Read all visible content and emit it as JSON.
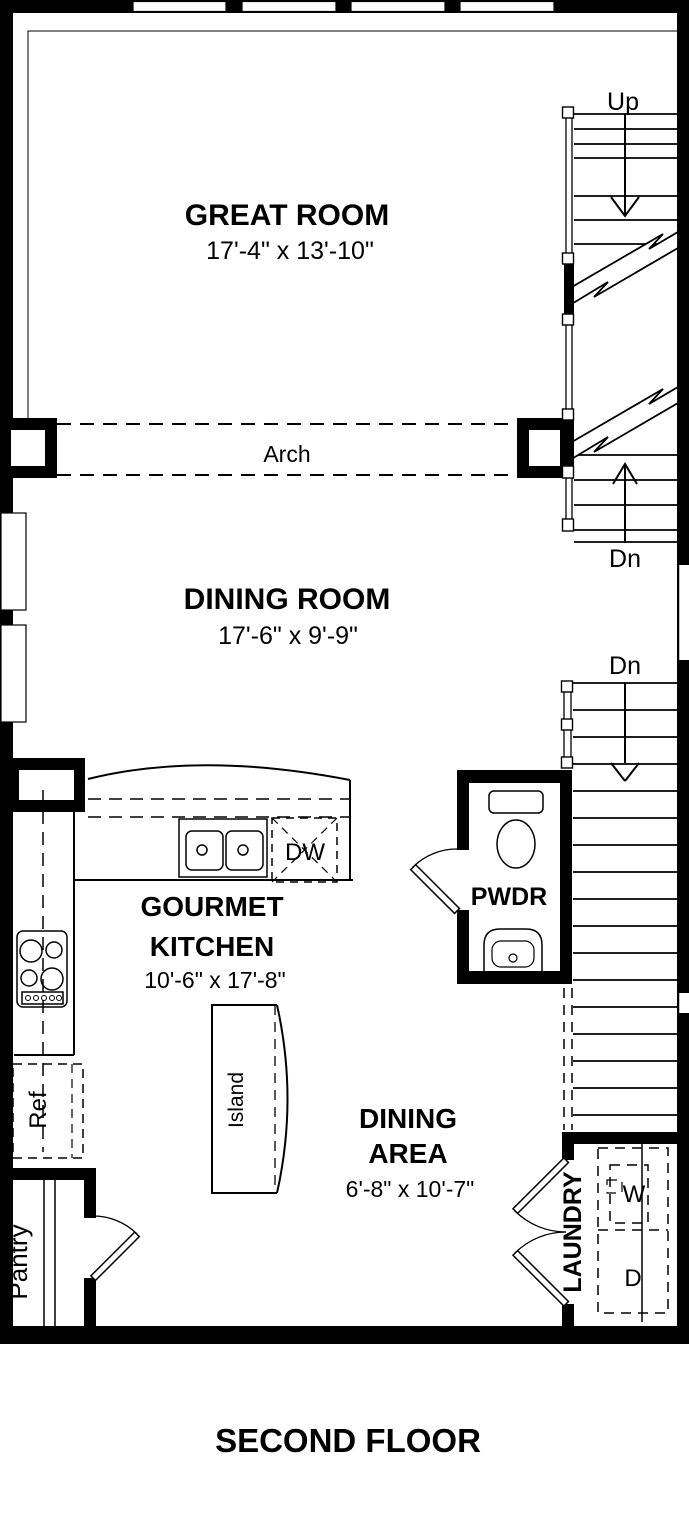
{
  "title": "SECOND FLOOR",
  "rooms": {
    "great_room": {
      "name": "GREAT ROOM",
      "dims": "17'-4\" x 13'-10\""
    },
    "dining_room": {
      "name": "DINING ROOM",
      "dims": "17'-6\" x 9'-9\""
    },
    "kitchen": {
      "line1": "GOURMET",
      "line2": "KITCHEN",
      "dims": "10'-6\" x 17'-8\""
    },
    "dining_area": {
      "line1": "DINING",
      "line2": "AREA",
      "dims": "6'-8\" x 10'-7\""
    },
    "powder": {
      "name": "PWDR"
    },
    "laundry": {
      "name": "LAUNDRY"
    },
    "pantry": {
      "name": "Pantry"
    }
  },
  "fixtures": {
    "ref": "Ref",
    "island": "Island",
    "dishwasher": "DW",
    "washer": "W",
    "dryer": "D"
  },
  "labels": {
    "arch": "Arch",
    "up": "Up",
    "dn_upper": "Dn",
    "dn_lower": "Dn"
  },
  "colors": {
    "wall": "#000000",
    "background": "#ffffff"
  }
}
